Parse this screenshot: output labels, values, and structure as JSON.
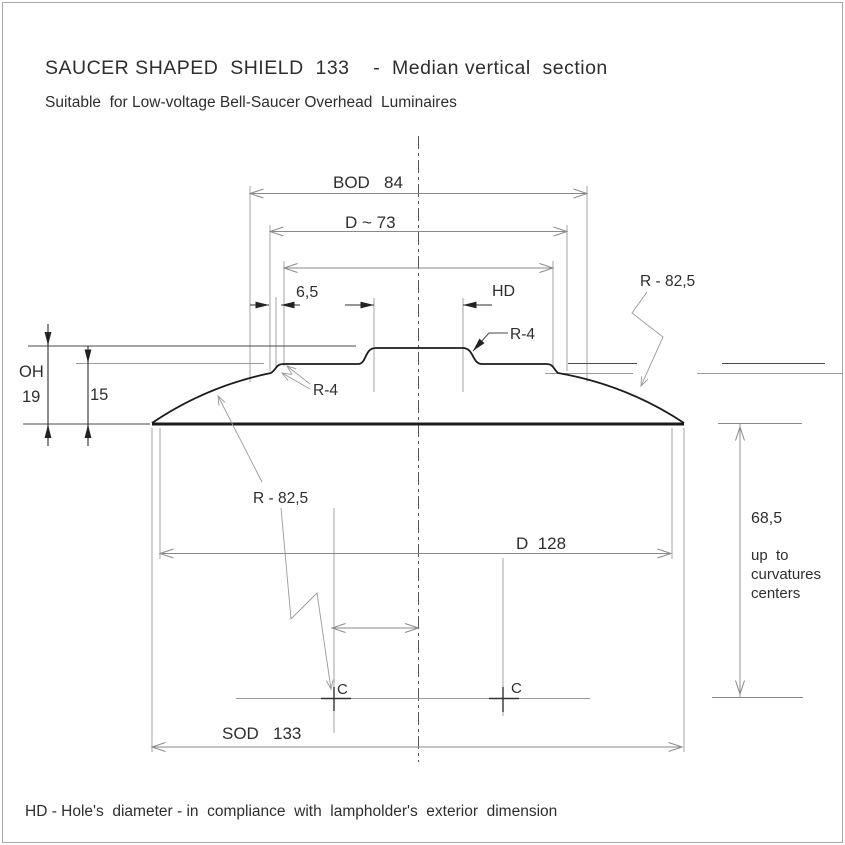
{
  "page": {
    "background": "#ffffff",
    "ink_color": "#2e2e2e",
    "line_color": "#8a8a8a"
  },
  "header": {
    "title": "SAUCER SHAPED  SHIELD  133    -  Median vertical  section",
    "subtitle": "Suitable  for Low-voltage Bell-Saucer Overhead  Luminaires"
  },
  "footer": {
    "note": "HD - Hole's  diameter - in  compliance  with  lampholder's  exterior  dimension"
  },
  "drawing": {
    "dimensions": {
      "bod": "BOD   84",
      "d_upper": "D ~ 73",
      "edge_offset": "6,5",
      "hole_diameter": "HD",
      "overall_height_label": "OH",
      "overall_height_value": "19",
      "inner_depth": "15",
      "radius_upper": "R - 82,5",
      "radius_lower": "R - 82,5",
      "fillet_upper": "R-4",
      "fillet_lower": "R-4",
      "d_lower": "D  128",
      "center_height": "68,5",
      "center_note_line1": "up  to",
      "center_note_line2": "curvatures",
      "center_note_line3": "centers",
      "sod": "SOD   133",
      "center_mark_left": "C",
      "center_mark_right": "C"
    }
  }
}
